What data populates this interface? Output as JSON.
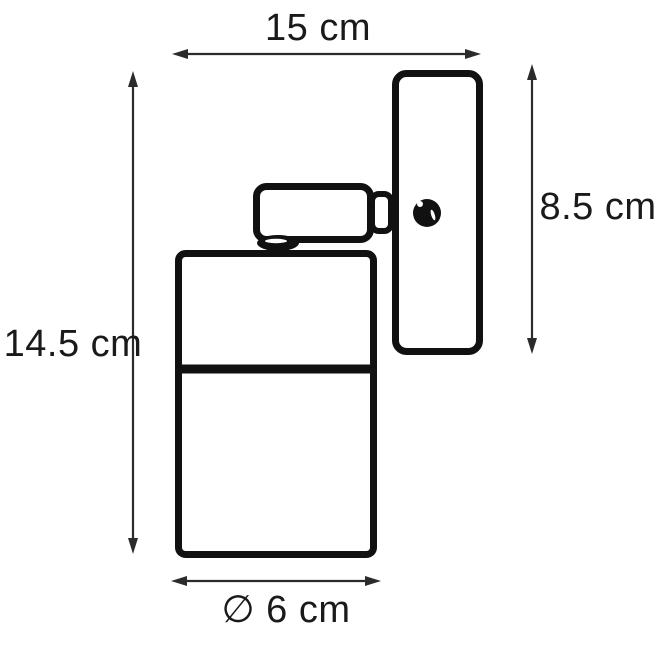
{
  "canvas": {
    "background": "#ffffff",
    "line_color": "#111111",
    "arrow_color": "#2b2b2b",
    "text_color": "#1a1a1a"
  },
  "diagram": {
    "type": "product-dimension-diagram",
    "parts": [
      "wall-plate",
      "mounting-screw",
      "swivel-arm",
      "arm-knuckle",
      "pivot-joint",
      "lamp-body",
      "lamp-body-seam"
    ],
    "dimensions": {
      "width_label": "15 cm",
      "total_height_label": "14.5 cm",
      "plate_height_label": "8.5 cm",
      "diameter_label": "∅ 6 cm"
    }
  }
}
